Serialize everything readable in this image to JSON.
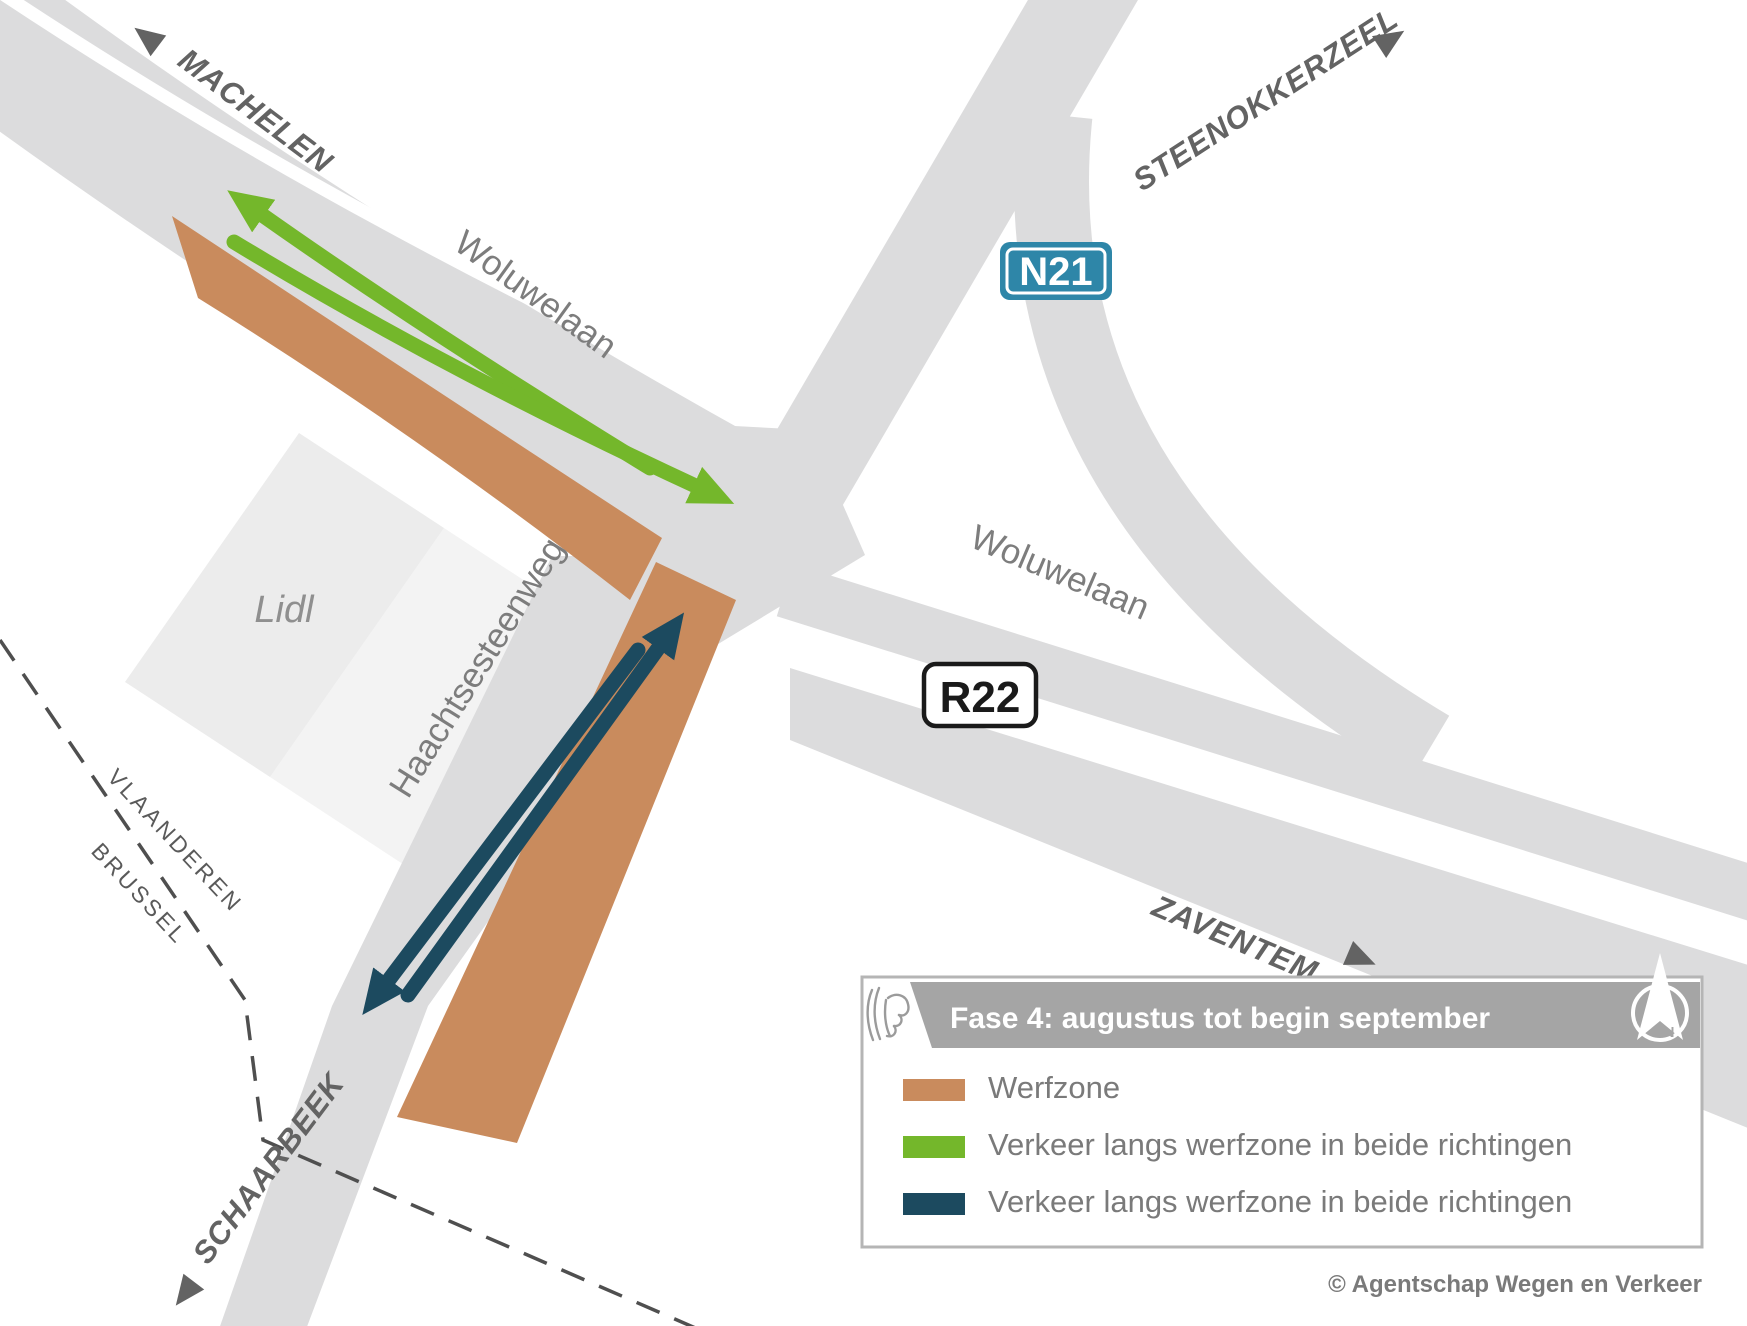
{
  "colors": {
    "road": "#dcdcdd",
    "parking": "#f3f3f3",
    "building": "#ececec",
    "werfzone": "#c98b5d",
    "traffic_green": "#74b72b",
    "traffic_navy": "#1c4a5f",
    "badge_n21_fill": "#2e86a8",
    "badge_r22_border": "#1a1a1a",
    "banner_gray": "#a5a5a5",
    "boundary_dash": "#4f4f4f"
  },
  "map": {
    "directions": {
      "machelen": "MACHELEN",
      "steenokkerzeel": "STEENOKKERZEEL",
      "zaventem": "ZAVENTEM",
      "schaarbeek": "SCHAARBEEK"
    },
    "roads": {
      "woluwelaan_nw": "Woluwelaan",
      "woluwelaan_e": "Woluwelaan",
      "haachtsesteenweg": "Haachtsesteenweg"
    },
    "badges": {
      "n21": "N21",
      "r22": "R22"
    },
    "areas": {
      "lidl": "Lidl"
    },
    "boundary": {
      "north": "VLAANDEREN",
      "south": "BRUSSEL"
    }
  },
  "legend": {
    "title": "Fase 4: augustus tot begin september",
    "compass": "N",
    "items": [
      {
        "label": "Werfzone",
        "color": "#c98b5d"
      },
      {
        "label": "Verkeer langs werfzone in beide richtingen",
        "color": "#74b72b"
      },
      {
        "label": "Verkeer langs werfzone in beide richtingen",
        "color": "#1c4a5f"
      }
    ]
  },
  "credit": "© Agentschap Wegen en Verkeer"
}
